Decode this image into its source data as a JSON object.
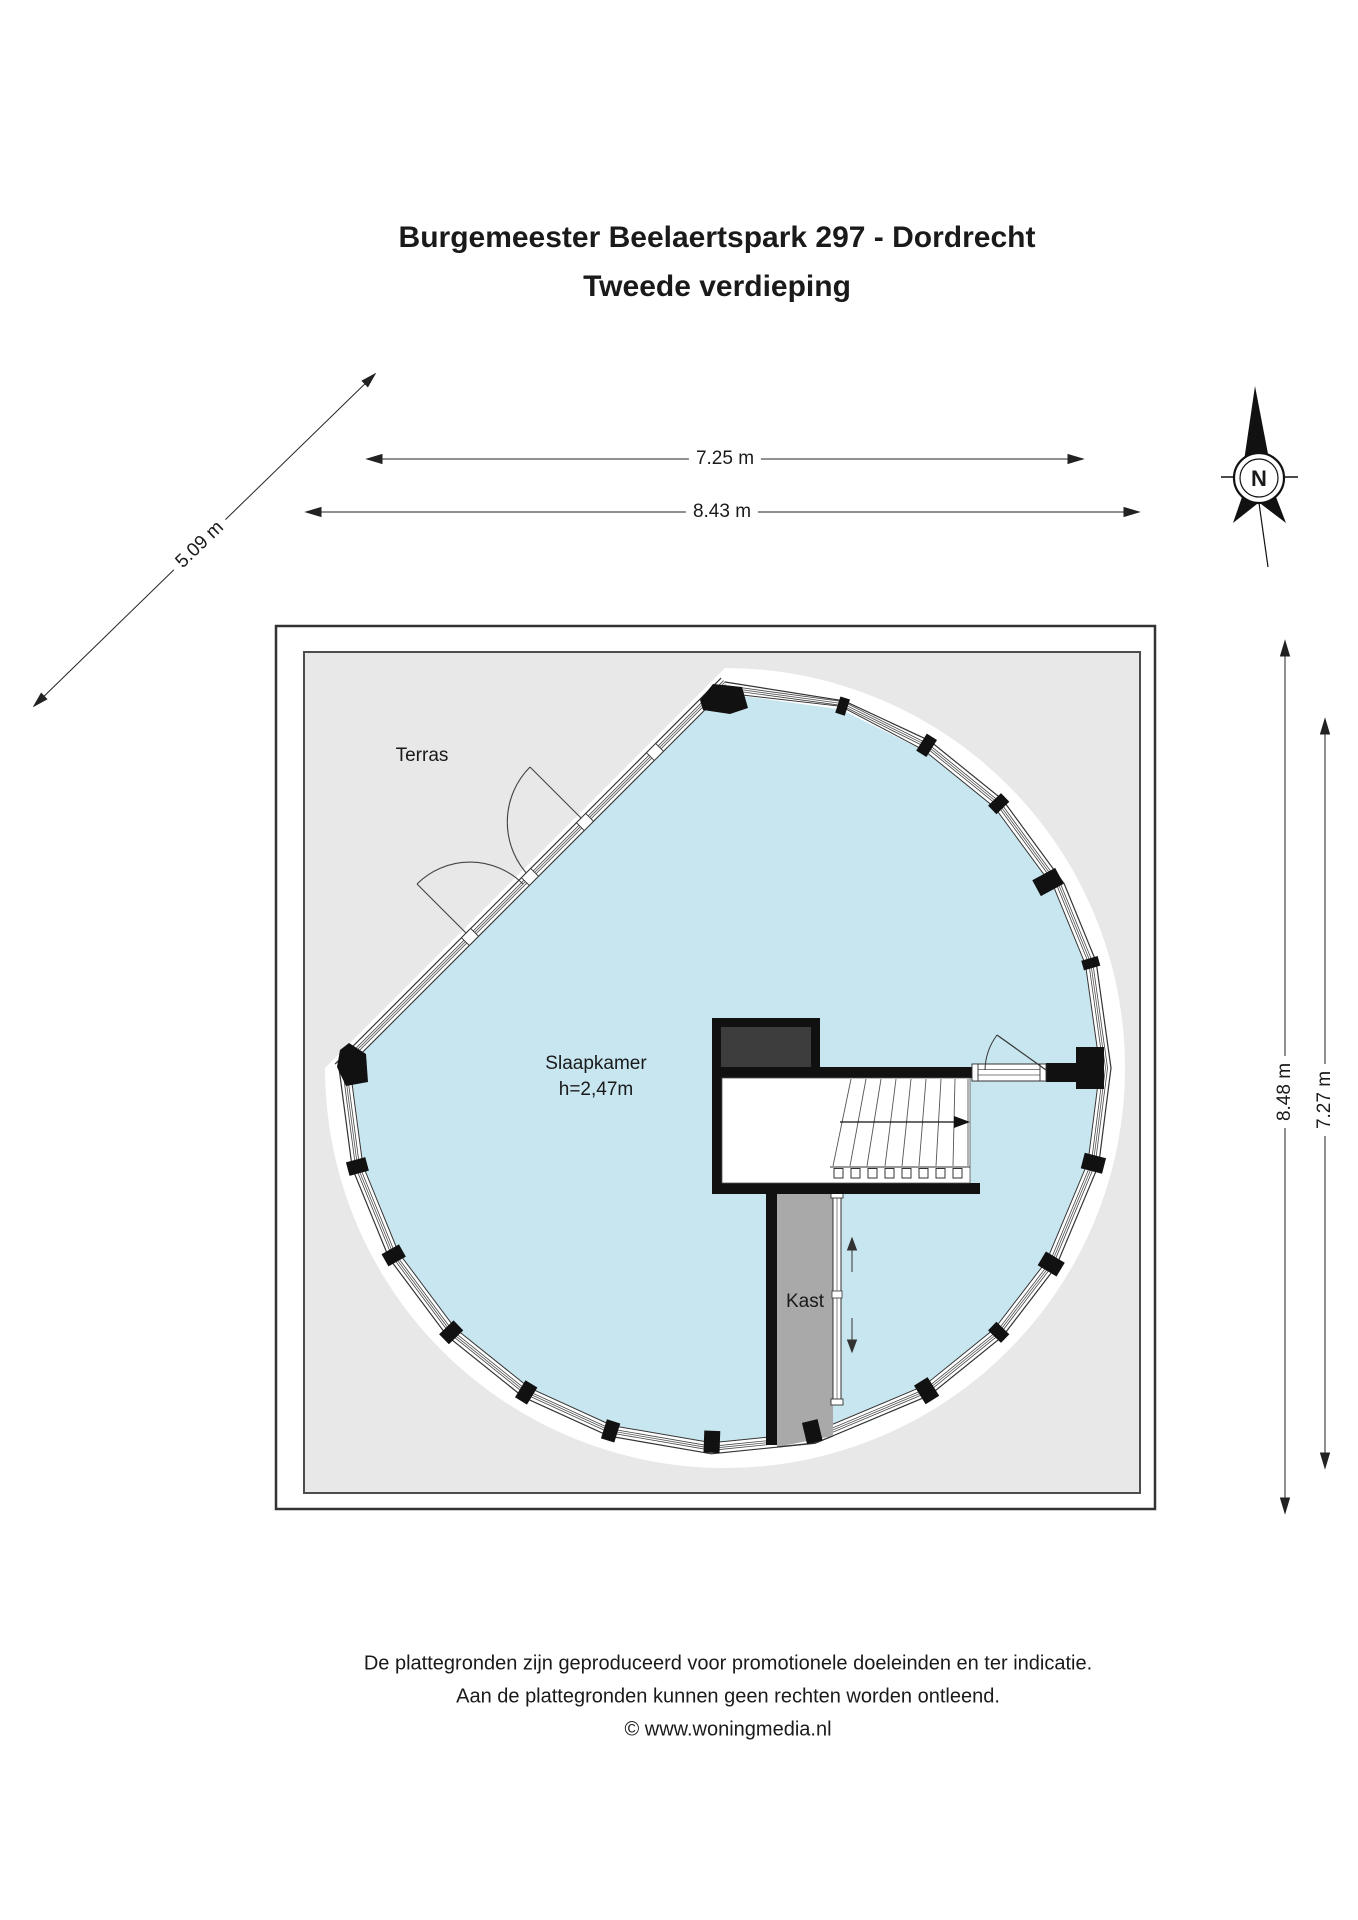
{
  "title": {
    "line1": "Burgemeester Beelaertspark 297 - Dordrecht",
    "line2": "Tweede verdieping"
  },
  "labels": {
    "terrace": "Terras",
    "bedroom": "Slaapkamer",
    "bedroom_height": "h=2,47m",
    "closet": "Kast"
  },
  "dimensions": {
    "top_inner": "7.25 m",
    "top_outer": "8.43 m",
    "diagonal": "5.09 m",
    "right_outer": "8.48 m",
    "right_inner": "7.27 m"
  },
  "compass": {
    "north": "N"
  },
  "footer": {
    "line1": "De plattegronden zijn geproduceerd voor promotionele doeleinden en ter indicatie.",
    "line2": "Aan de plattegronden kunnen geen rechten worden ontleend.",
    "line3": "© www.woningmedia.nl"
  },
  "colors": {
    "bedroom_fill": "#c8e6f0",
    "terrace_fill": "#e8e8e8",
    "closet_fill": "#a9a9a9",
    "wall": "#111111",
    "text": "#1a1a1a"
  }
}
